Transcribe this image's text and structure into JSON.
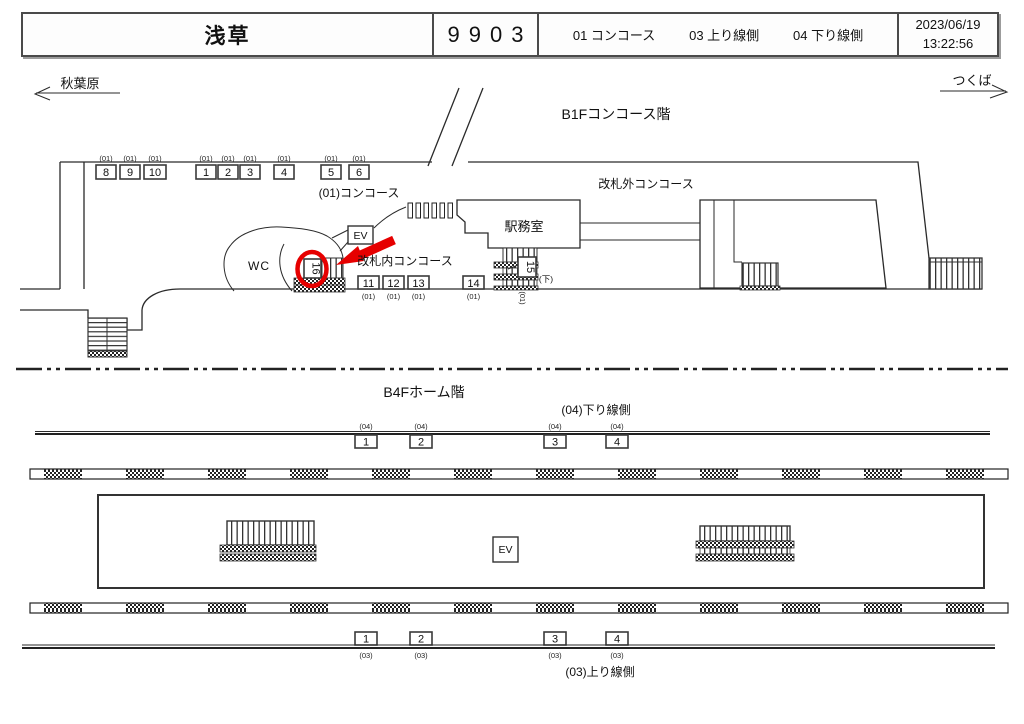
{
  "header": {
    "station_name": "浅草",
    "station_code": "9903",
    "zone_01": "01 コンコース",
    "zone_03": "03 上り線側",
    "zone_04": "04 下り線側",
    "date": "2023/06/19",
    "time": "13:22:56"
  },
  "nav": {
    "left_station": "秋葉原",
    "right_station": "つくば"
  },
  "b1f": {
    "floor_label": "B1Fコンコース階",
    "labels": {
      "concourse": "(01)コンコース",
      "outside_gates": "改札外コンコース",
      "inside_gates": "改札内コンコース",
      "station_office": "駅務室",
      "restroom": "WC",
      "elevator": "EV",
      "down_note": "(下)"
    },
    "cameras_top": [
      {
        "id": "8",
        "group": "(01)"
      },
      {
        "id": "9",
        "group": "(01)"
      },
      {
        "id": "10",
        "group": "(01)"
      },
      {
        "id": "1",
        "group": "(01)"
      },
      {
        "id": "2",
        "group": "(01)"
      },
      {
        "id": "3",
        "group": "(01)"
      },
      {
        "id": "4",
        "group": "(01)"
      },
      {
        "id": "5",
        "group": "(01)"
      },
      {
        "id": "6",
        "group": "(01)"
      }
    ],
    "cameras_mid": [
      {
        "id": "11",
        "group": "(01)"
      },
      {
        "id": "12",
        "group": "(01)"
      },
      {
        "id": "13",
        "group": "(01)"
      },
      {
        "id": "14",
        "group": "(01)"
      }
    ],
    "camera_15": {
      "id": "15",
      "group": "(01)"
    },
    "camera_16": {
      "id": "16"
    }
  },
  "b4f": {
    "floor_label": "B4Fホーム階",
    "labels": {
      "down_line": "(04)下り線側",
      "up_line": "(03)上り線側",
      "elevator": "EV"
    },
    "cameras_down": [
      {
        "id": "1",
        "group": "(04)"
      },
      {
        "id": "2",
        "group": "(04)"
      },
      {
        "id": "3",
        "group": "(04)"
      },
      {
        "id": "4",
        "group": "(04)"
      }
    ],
    "cameras_up": [
      {
        "id": "1",
        "group": "(03)"
      },
      {
        "id": "2",
        "group": "(03)"
      },
      {
        "id": "3",
        "group": "(03)"
      },
      {
        "id": "4",
        "group": "(03)"
      }
    ]
  },
  "highlight": {
    "color": "#e60000"
  }
}
